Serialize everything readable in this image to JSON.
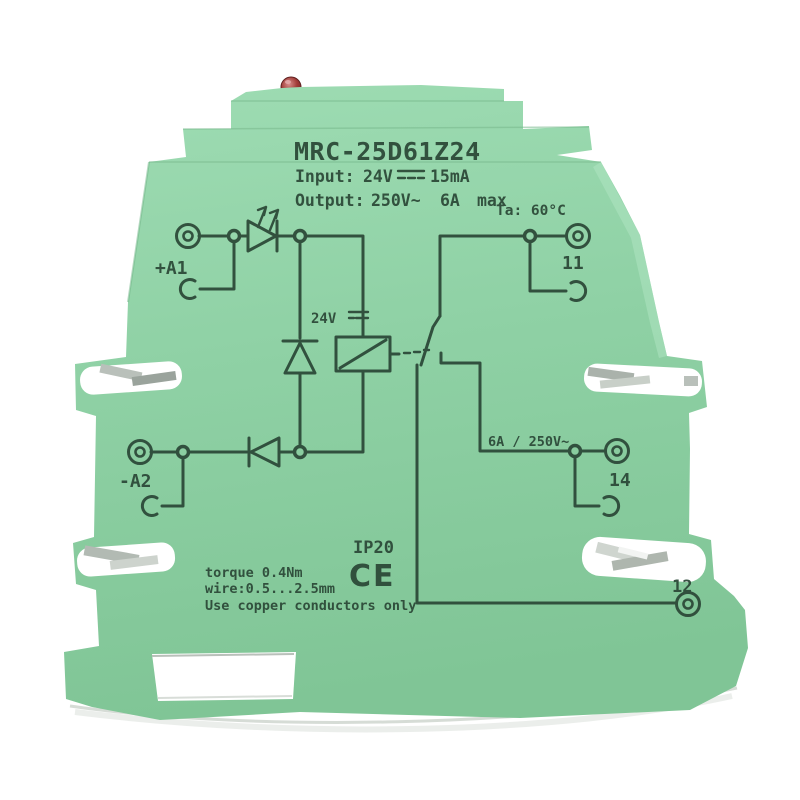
{
  "product": {
    "model": "MRC-25D61Z24",
    "input_label": "Input:",
    "input_voltage": "24V",
    "input_current": "15mA",
    "output_label": "Output:",
    "output_voltage": "250V~",
    "output_current": "6A",
    "output_max": "max",
    "ambient_temp": "Ta: 60°C"
  },
  "schematic": {
    "terminal_a1": "+A1",
    "terminal_a2": "-A2",
    "terminal_11": "11",
    "terminal_14": "14",
    "terminal_12": "12",
    "coil_voltage": "24V",
    "contact_rating": "6A / 250V~"
  },
  "markings": {
    "ip_rating": "IP20",
    "ce_mark": "CE",
    "torque": "torque 0.4Nm",
    "wire_range": "wire:0.5...2.5mm",
    "copper_note": "Use copper conductors only"
  },
  "colors": {
    "body_green": "#8fd1a5",
    "print_dark": "#2d4a39",
    "led_red": "#a13c38",
    "metal_grey": "#b7bfb8",
    "background": "#ffffff"
  }
}
